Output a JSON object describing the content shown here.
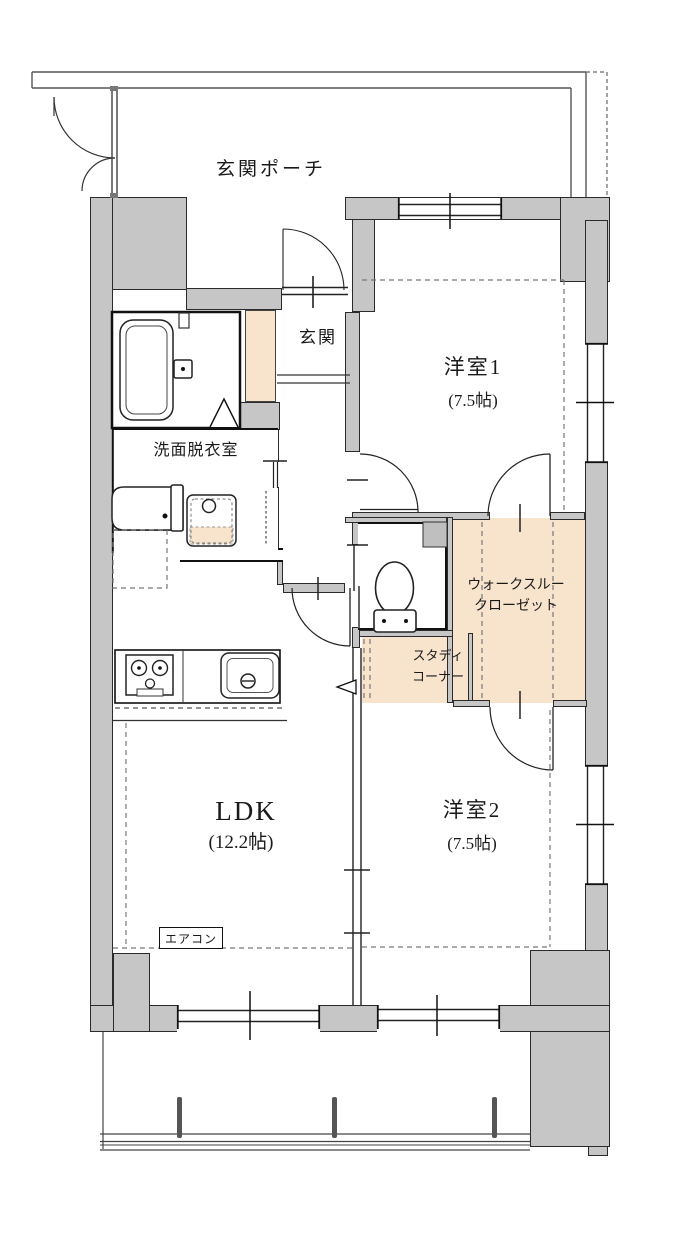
{
  "plan": {
    "title": "2LDK apartment floor plan",
    "labels": {
      "porch": "玄関ポーチ",
      "genkan": "玄関",
      "room1_name": "洋室1",
      "room1_size": "(7.5帖)",
      "washroom": "洗面脱衣室",
      "wtc_line1": "ウォークスルー",
      "wtc_line2": "クローゼット",
      "study_line1": "スタディ",
      "study_line2": "コーナー",
      "ldk_name": "LDK",
      "ldk_size": "(12.2帖)",
      "room2_name": "洋室2",
      "room2_size": "(7.5帖)",
      "aircon": "エアコン"
    },
    "colors": {
      "wall_fill": "#c5c6c5",
      "accent_floor_fill": "#f8e3cd",
      "line": "#1a1a1a"
    }
  }
}
